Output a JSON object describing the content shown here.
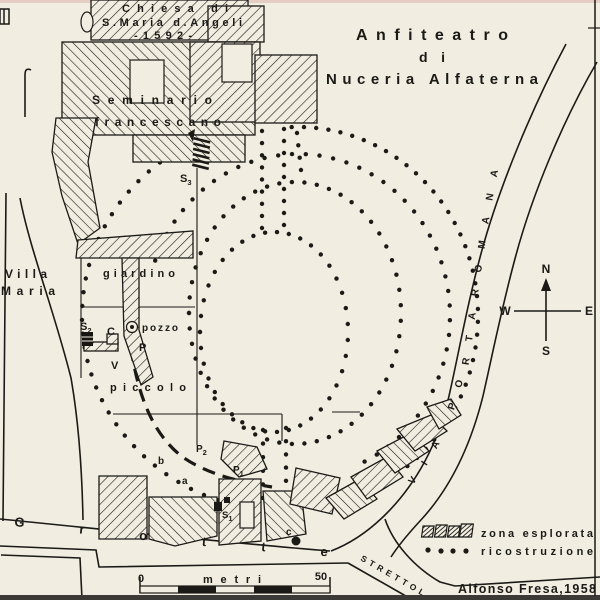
{
  "colors": {
    "paper": "#f1ede0",
    "ink": "#1b1a17"
  },
  "title": {
    "line1": "Anfiteatro",
    "line2": "di",
    "line3": "Nuceria Alfaterna"
  },
  "buildings": {
    "church_line1": "Chiesa di",
    "church_line2": "S.Maria d.Angeli",
    "church_line3": "-1592-",
    "seminary_line1": "Seminario",
    "seminary_line2": "francescano",
    "villa_line1": "Villa",
    "villa_line2": "Maria"
  },
  "site": {
    "garden": "giardino",
    "well": "pozzo",
    "small": "piccolo"
  },
  "streets": {
    "grotte": "Grotte",
    "strettola": "STRETTOLA",
    "via_portaromana": "VIA  PORTAROMANA"
  },
  "markers": {
    "s2": {
      "base": "S",
      "sub": "2"
    },
    "s3": {
      "base": "S",
      "sub": "3"
    },
    "s1": {
      "base": "S",
      "sub": "1"
    },
    "p1": {
      "base": "P",
      "sub": "1"
    },
    "p2": {
      "base": "P",
      "sub": "2"
    },
    "c_upper": "C",
    "p": "P",
    "v": "V",
    "a": "a",
    "b": "b",
    "c_lower": "c"
  },
  "compass": {
    "north": "N",
    "south": "S",
    "east": "E",
    "west": "W"
  },
  "legend": {
    "explored": "zona esplorata",
    "reconstruction": "ricostruzione"
  },
  "scale_bar": {
    "start": "0",
    "unit": "metri",
    "end": "50"
  },
  "credit": "Alfonso Fresa,1958",
  "reconstruction": {
    "dot_radius": 2.2,
    "arcs": [
      {
        "cx": 298,
        "cy": 316,
        "rx": 180,
        "ry": 189,
        "a0": -92,
        "a1": 76,
        "n": 44
      },
      {
        "cx": 288,
        "cy": 316,
        "rx": 206,
        "ry": 196,
        "a0": 110,
        "a1": 268,
        "n": 40
      },
      {
        "cx": 298,
        "cy": 316,
        "rx": 152,
        "ry": 162,
        "a0": -160,
        "a1": 64,
        "n": 44
      },
      {
        "cx": 295,
        "cy": 313,
        "rx": 106,
        "ry": 131,
        "a0": -180,
        "a1": 180,
        "n": 54
      },
      {
        "cx": 274,
        "cy": 332,
        "rx": 74,
        "ry": 100,
        "a0": -180,
        "a1": 180,
        "n": 40
      }
    ],
    "lines": [
      {
        "x1": 262,
        "y1": 131,
        "x2": 262,
        "y2": 228,
        "n": 9
      },
      {
        "x1": 284,
        "y1": 129,
        "x2": 284,
        "y2": 225,
        "n": 9
      },
      {
        "x1": 297,
        "y1": 133,
        "x2": 301,
        "y2": 170,
        "n": 4
      },
      {
        "x1": 263,
        "y1": 430,
        "x2": 263,
        "y2": 498,
        "n": 6
      },
      {
        "x1": 286,
        "y1": 428,
        "x2": 286,
        "y2": 494,
        "n": 6
      }
    ]
  }
}
